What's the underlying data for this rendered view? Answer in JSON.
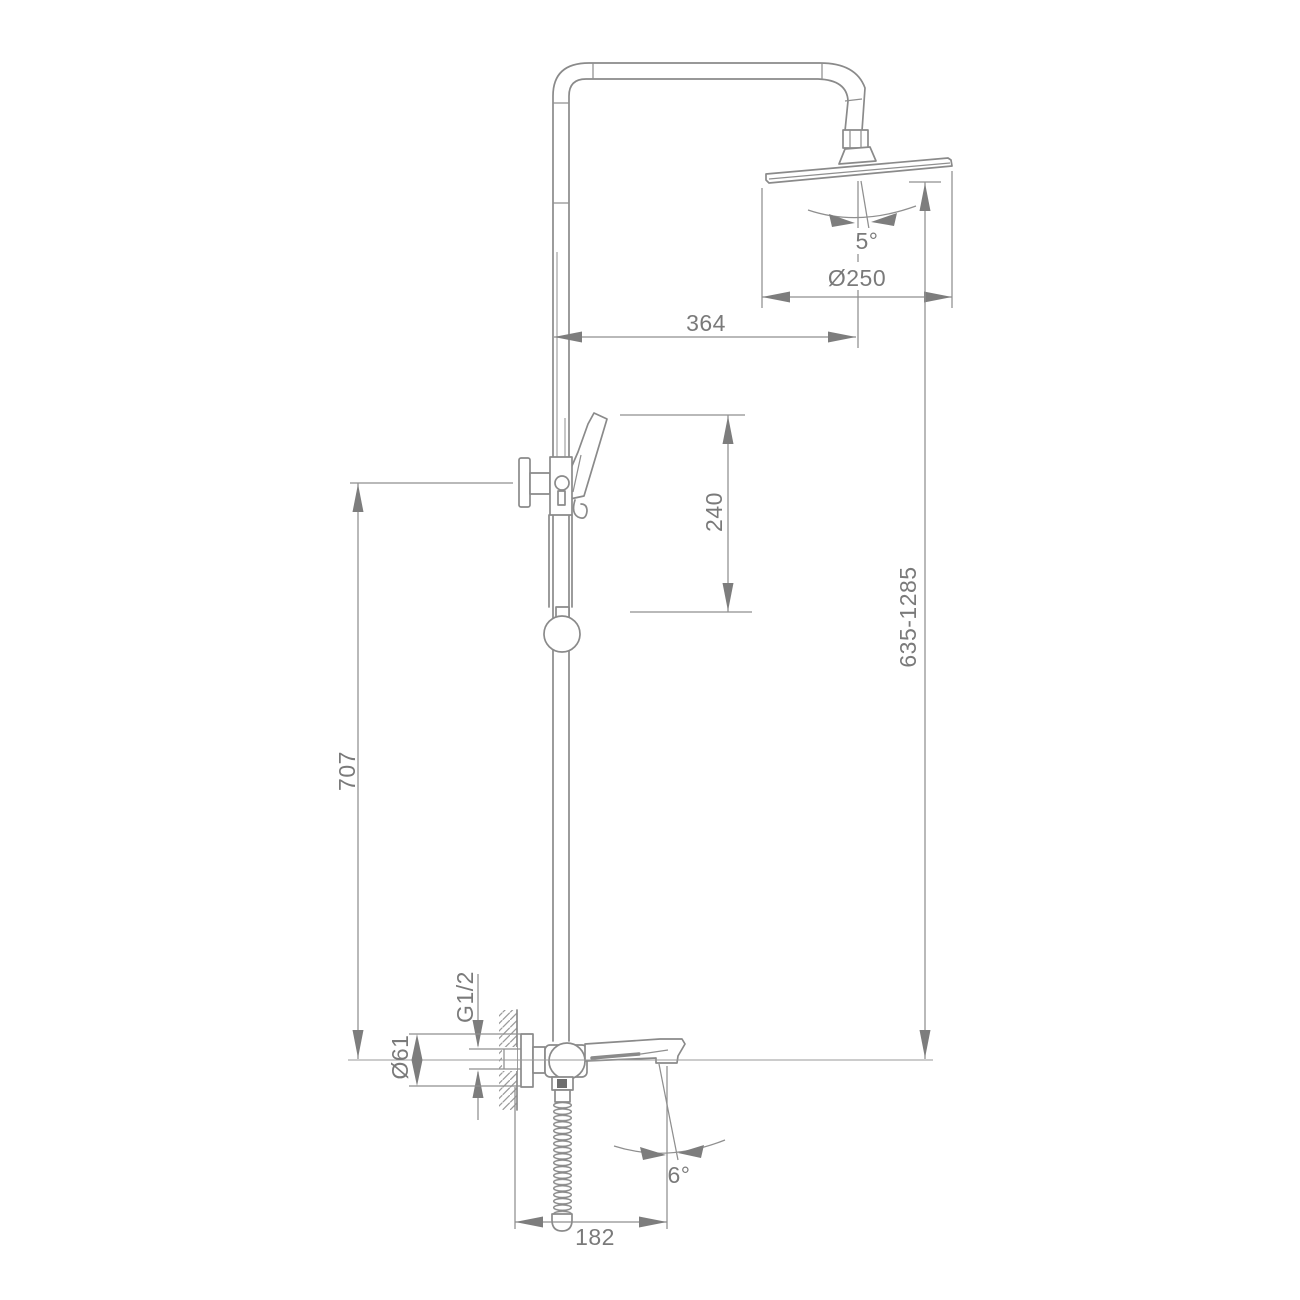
{
  "drawing": {
    "type": "technical-dimension-drawing",
    "subject": "shower-column-with-rain-head-hand-shower-and-spout-mixer",
    "background": "#ffffff",
    "line_color": "#8a8a8a",
    "text_color": "#7a7a7a",
    "labels": {
      "head_diameter": "Ø250",
      "arm_reach": "364",
      "head_tilt_angle": "5°",
      "slider_travel": "240",
      "column_height_range": "635-1285",
      "holder_height": "707",
      "inlet_thread": "G1/2",
      "escutcheon_diameter": "Ø61",
      "spout_reach": "182",
      "spout_tilt_angle": "6°"
    }
  }
}
